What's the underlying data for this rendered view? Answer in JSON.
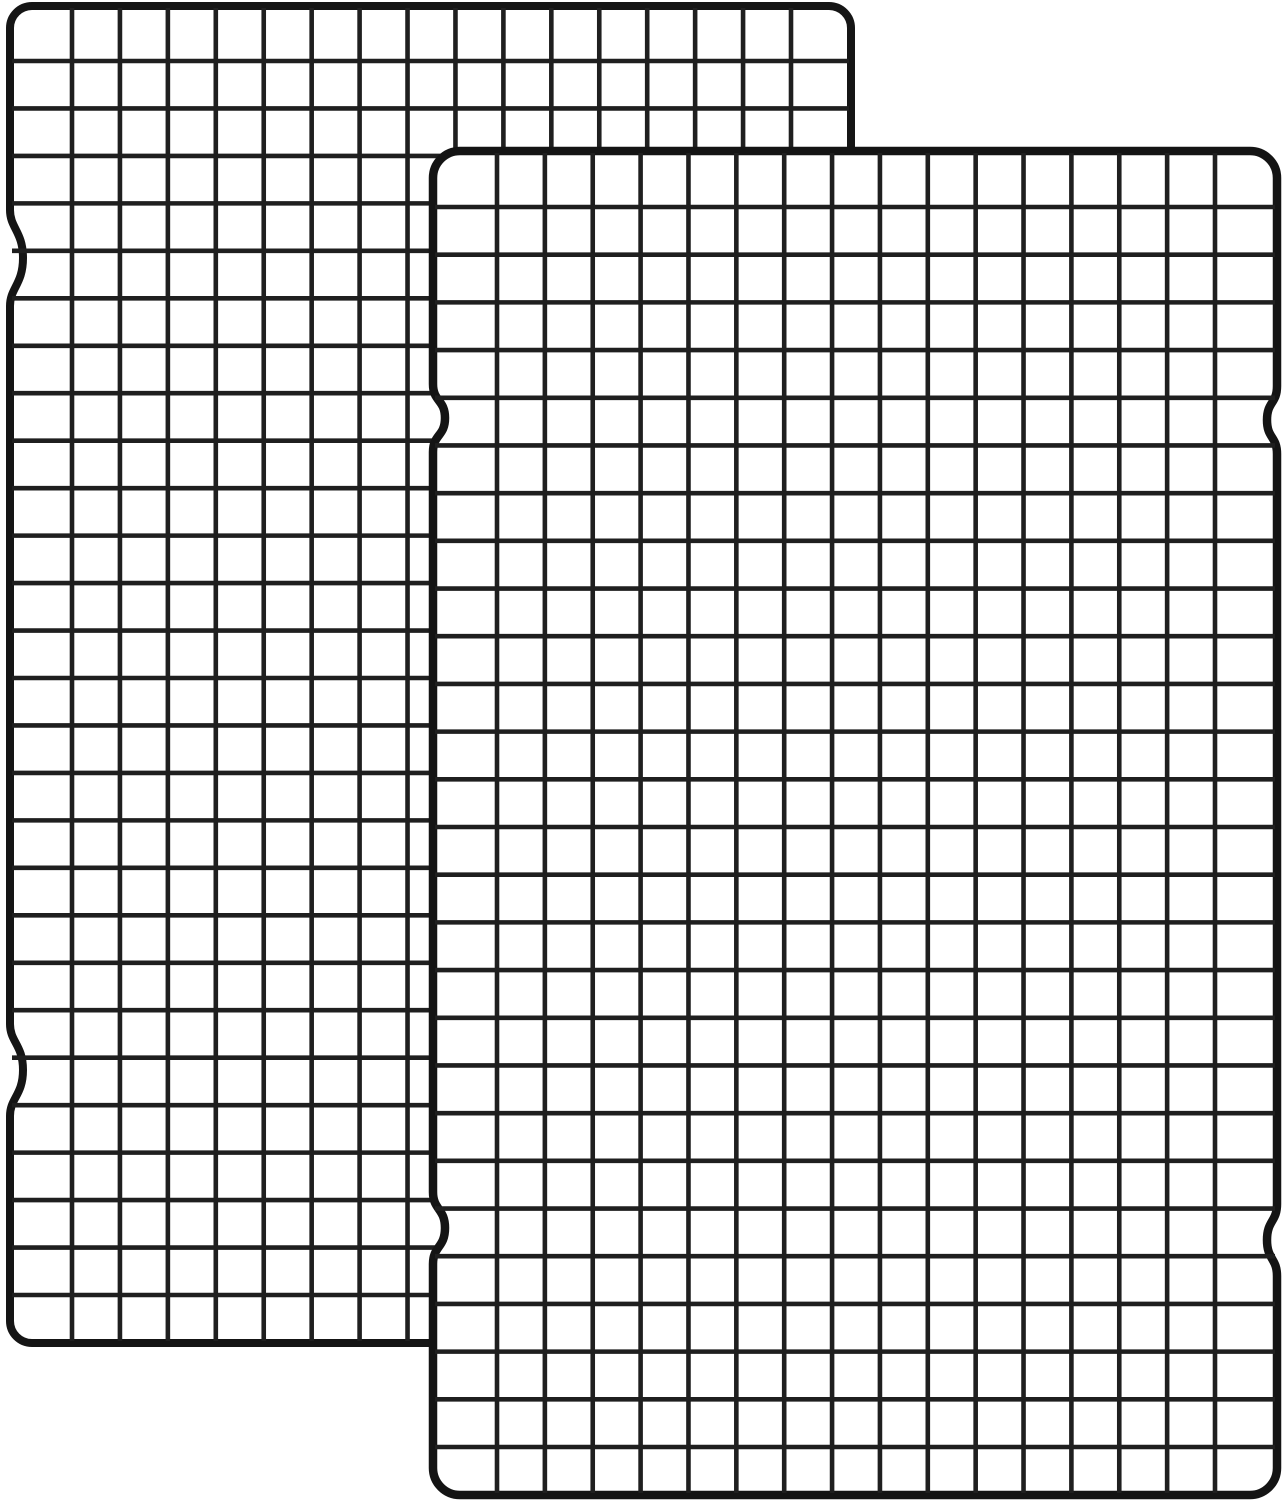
{
  "meta": {
    "type": "product-photo",
    "subject": "Two-pack of black steel wire grid cooling racks, overlapping diagonally on a white background",
    "background_color": "#ffffff",
    "visible_text": ""
  },
  "canvas": {
    "width": 1283,
    "height": 1500
  },
  "racks": [
    {
      "name": "cooling-rack-back",
      "x": 10,
      "y": 6,
      "width": 841,
      "height": 1337,
      "corner_radius": 22,
      "fill_color": "#ffffff",
      "frame_color": "#151515",
      "frame_width": 8,
      "wire_color": "#1f1f1f",
      "wire_width": 4.6,
      "columns": 17,
      "rows": 28,
      "internal_vertical_wires": 16,
      "internal_horizontal_wires": 27,
      "inset_left": 62,
      "inset_right": 60,
      "inset_top": 55,
      "inset_bottom": 48,
      "notches_left": [
        {
          "cy": 258,
          "half": 48,
          "depth": 13
        },
        {
          "cy": 1070,
          "half": 46,
          "depth": 13
        }
      ],
      "notches_right": [
        {
          "cy": 258,
          "half": 48,
          "depth": 13
        },
        {
          "cy": 1070,
          "half": 46,
          "depth": 13
        }
      ]
    },
    {
      "name": "cooling-rack-front",
      "x": 433,
      "y": 151,
      "width": 844,
      "height": 1344,
      "corner_radius": 27,
      "fill_color": "#ffffff",
      "frame_color": "#141414",
      "frame_width": 8.5,
      "wire_color": "#1f1f1f",
      "wire_width": 4.6,
      "columns": 17,
      "rows": 28,
      "internal_vertical_wires": 16,
      "internal_horizontal_wires": 27,
      "inset_left": 64,
      "inset_right": 62,
      "inset_top": 56,
      "inset_bottom": 48,
      "notches_left": [
        {
          "cy": 418,
          "half": 34,
          "depth": 12
        },
        {
          "cy": 1228,
          "half": 36,
          "depth": 12
        }
      ],
      "notches_right": [
        {
          "cy": 420,
          "half": 34,
          "depth": 10
        },
        {
          "cy": 1240,
          "half": 36,
          "depth": 10
        }
      ]
    }
  ]
}
